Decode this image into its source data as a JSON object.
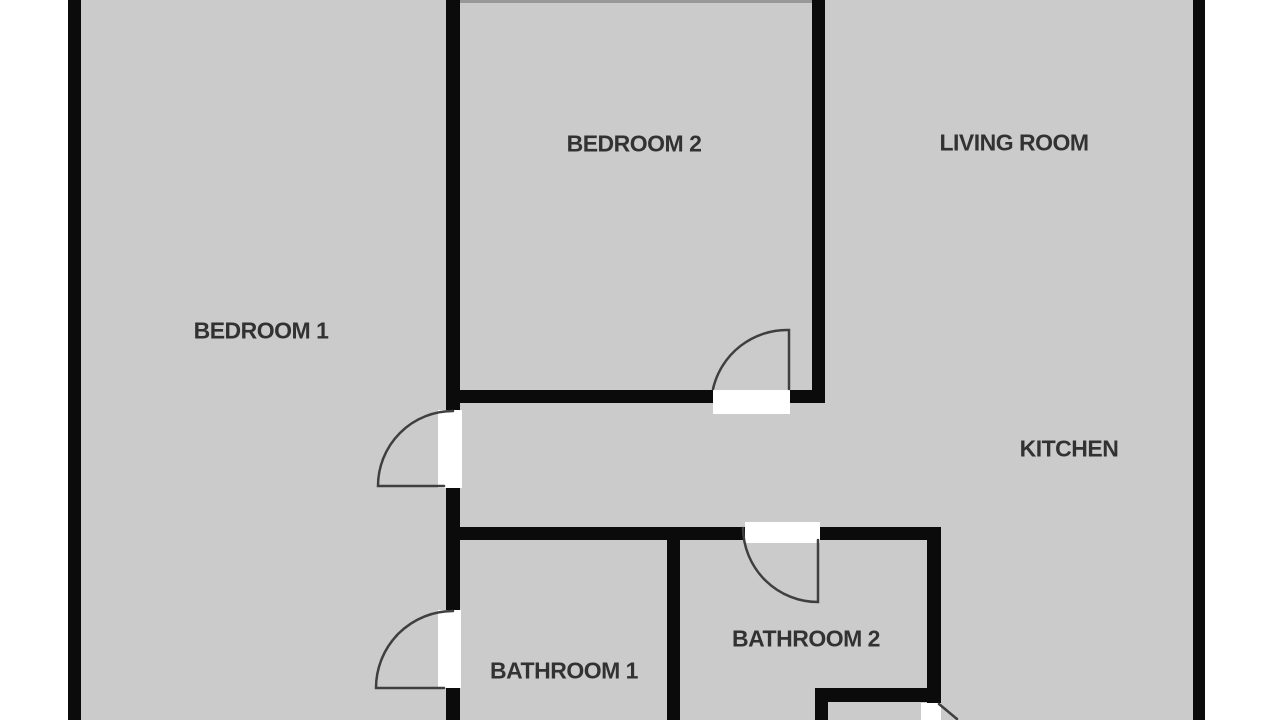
{
  "title": "Apartment floor plan",
  "colors": {
    "floor": "#cbcbcb",
    "wall": "#0b0b0b",
    "margin": "#ffffff",
    "door_gap": "#ffffff",
    "door_arc": "#3f3f3f",
    "label_text": "#323232"
  },
  "rooms": {
    "bedroom1": {
      "label": "BEDROOM 1"
    },
    "bedroom2": {
      "label": "BEDROOM 2"
    },
    "living": {
      "label": "LIVING ROOM"
    },
    "kitchen": {
      "label": "KITCHEN"
    },
    "bathroom1": {
      "label": "BATHROOM 1"
    },
    "bathroom2": {
      "label": "BATHROOM 2"
    }
  }
}
